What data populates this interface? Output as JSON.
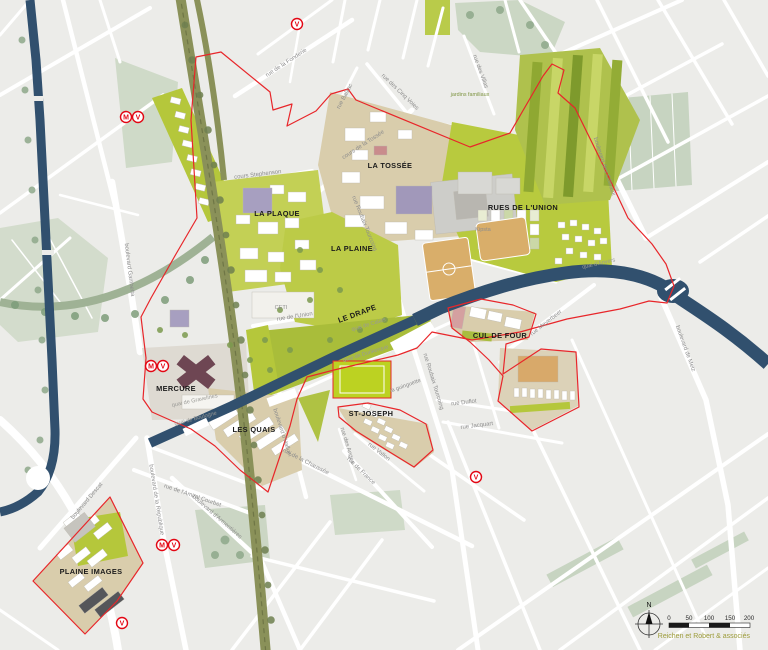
{
  "map": {
    "attribution": "Reichen et Robert & associés",
    "compass_north": "N",
    "scale_ticks": [
      "0",
      "50",
      "100",
      "150",
      "200"
    ]
  },
  "districts": [
    {
      "text": "LA TOSSÉE"
    },
    {
      "text": "LA PLAQUE"
    },
    {
      "text": "LA PLAINE"
    },
    {
      "text": "RUES DE L'UNION"
    },
    {
      "text": "LE DRAPE"
    },
    {
      "text": "MERCURE"
    },
    {
      "text": "LES QUAIS"
    },
    {
      "text": "ST-JOSEPH"
    },
    {
      "text": "CUL DE FOUR"
    },
    {
      "text": "PLAINE IMAGES"
    }
  ],
  "streets": [
    {
      "text": "rue de la Fonderie"
    },
    {
      "text": "rue des Villas"
    },
    {
      "text": "rue Balzac"
    },
    {
      "text": "rue des Cinq Voies"
    },
    {
      "text": "cours de la Tossée"
    },
    {
      "text": "cours Stephenson"
    },
    {
      "text": "rue Roubaix Tourcoing"
    },
    {
      "text": "rue Roubaix Tourcoing"
    },
    {
      "text": "rue de l'Union"
    },
    {
      "text": "quai de Calais"
    },
    {
      "text": "quai de Dunkerque"
    },
    {
      "text": "quai de Boulogne"
    },
    {
      "text": "quai de Gravelines"
    },
    {
      "text": "quai d'Anvers"
    },
    {
      "text": "boulevard des Côteaux"
    },
    {
      "text": "boulevard de Metz"
    },
    {
      "text": "rue Meyerbeer"
    },
    {
      "text": "rue Duflot"
    },
    {
      "text": "rue Jacquart"
    },
    {
      "text": "boulevard Gambetta"
    },
    {
      "text": "boulevard d'Halluin"
    },
    {
      "text": "rue de la Chaussée"
    },
    {
      "text": "rue de France"
    },
    {
      "text": "rue Vallon"
    },
    {
      "text": "rue des Anges"
    },
    {
      "text": "rue de l'Amiral Courbet"
    },
    {
      "text": "boulevard de la République"
    },
    {
      "text": "boulevard Descat"
    },
    {
      "text": "boulevard d'Armentières"
    }
  ],
  "places": [
    {
      "text": "CETI"
    },
    {
      "text": "Kipsta"
    },
    {
      "text": "jardins familiaux"
    },
    {
      "text": "la guinguette"
    }
  ],
  "transit_stations": [
    {
      "letter": "V"
    },
    {
      "letter": "M"
    },
    {
      "letter": "V"
    },
    {
      "letter": "M"
    },
    {
      "letter": "V"
    },
    {
      "letter": "M"
    },
    {
      "letter": "V"
    },
    {
      "letter": "V"
    },
    {
      "letter": "V"
    }
  ],
  "colors": {
    "canal": "#31506E",
    "project_green": "#B8CA3E",
    "boundary_red": "#E8262A",
    "transit_red": "#E30613",
    "ground_tan": "#D9CDAC",
    "attribution_olive": "#9C9B39"
  }
}
